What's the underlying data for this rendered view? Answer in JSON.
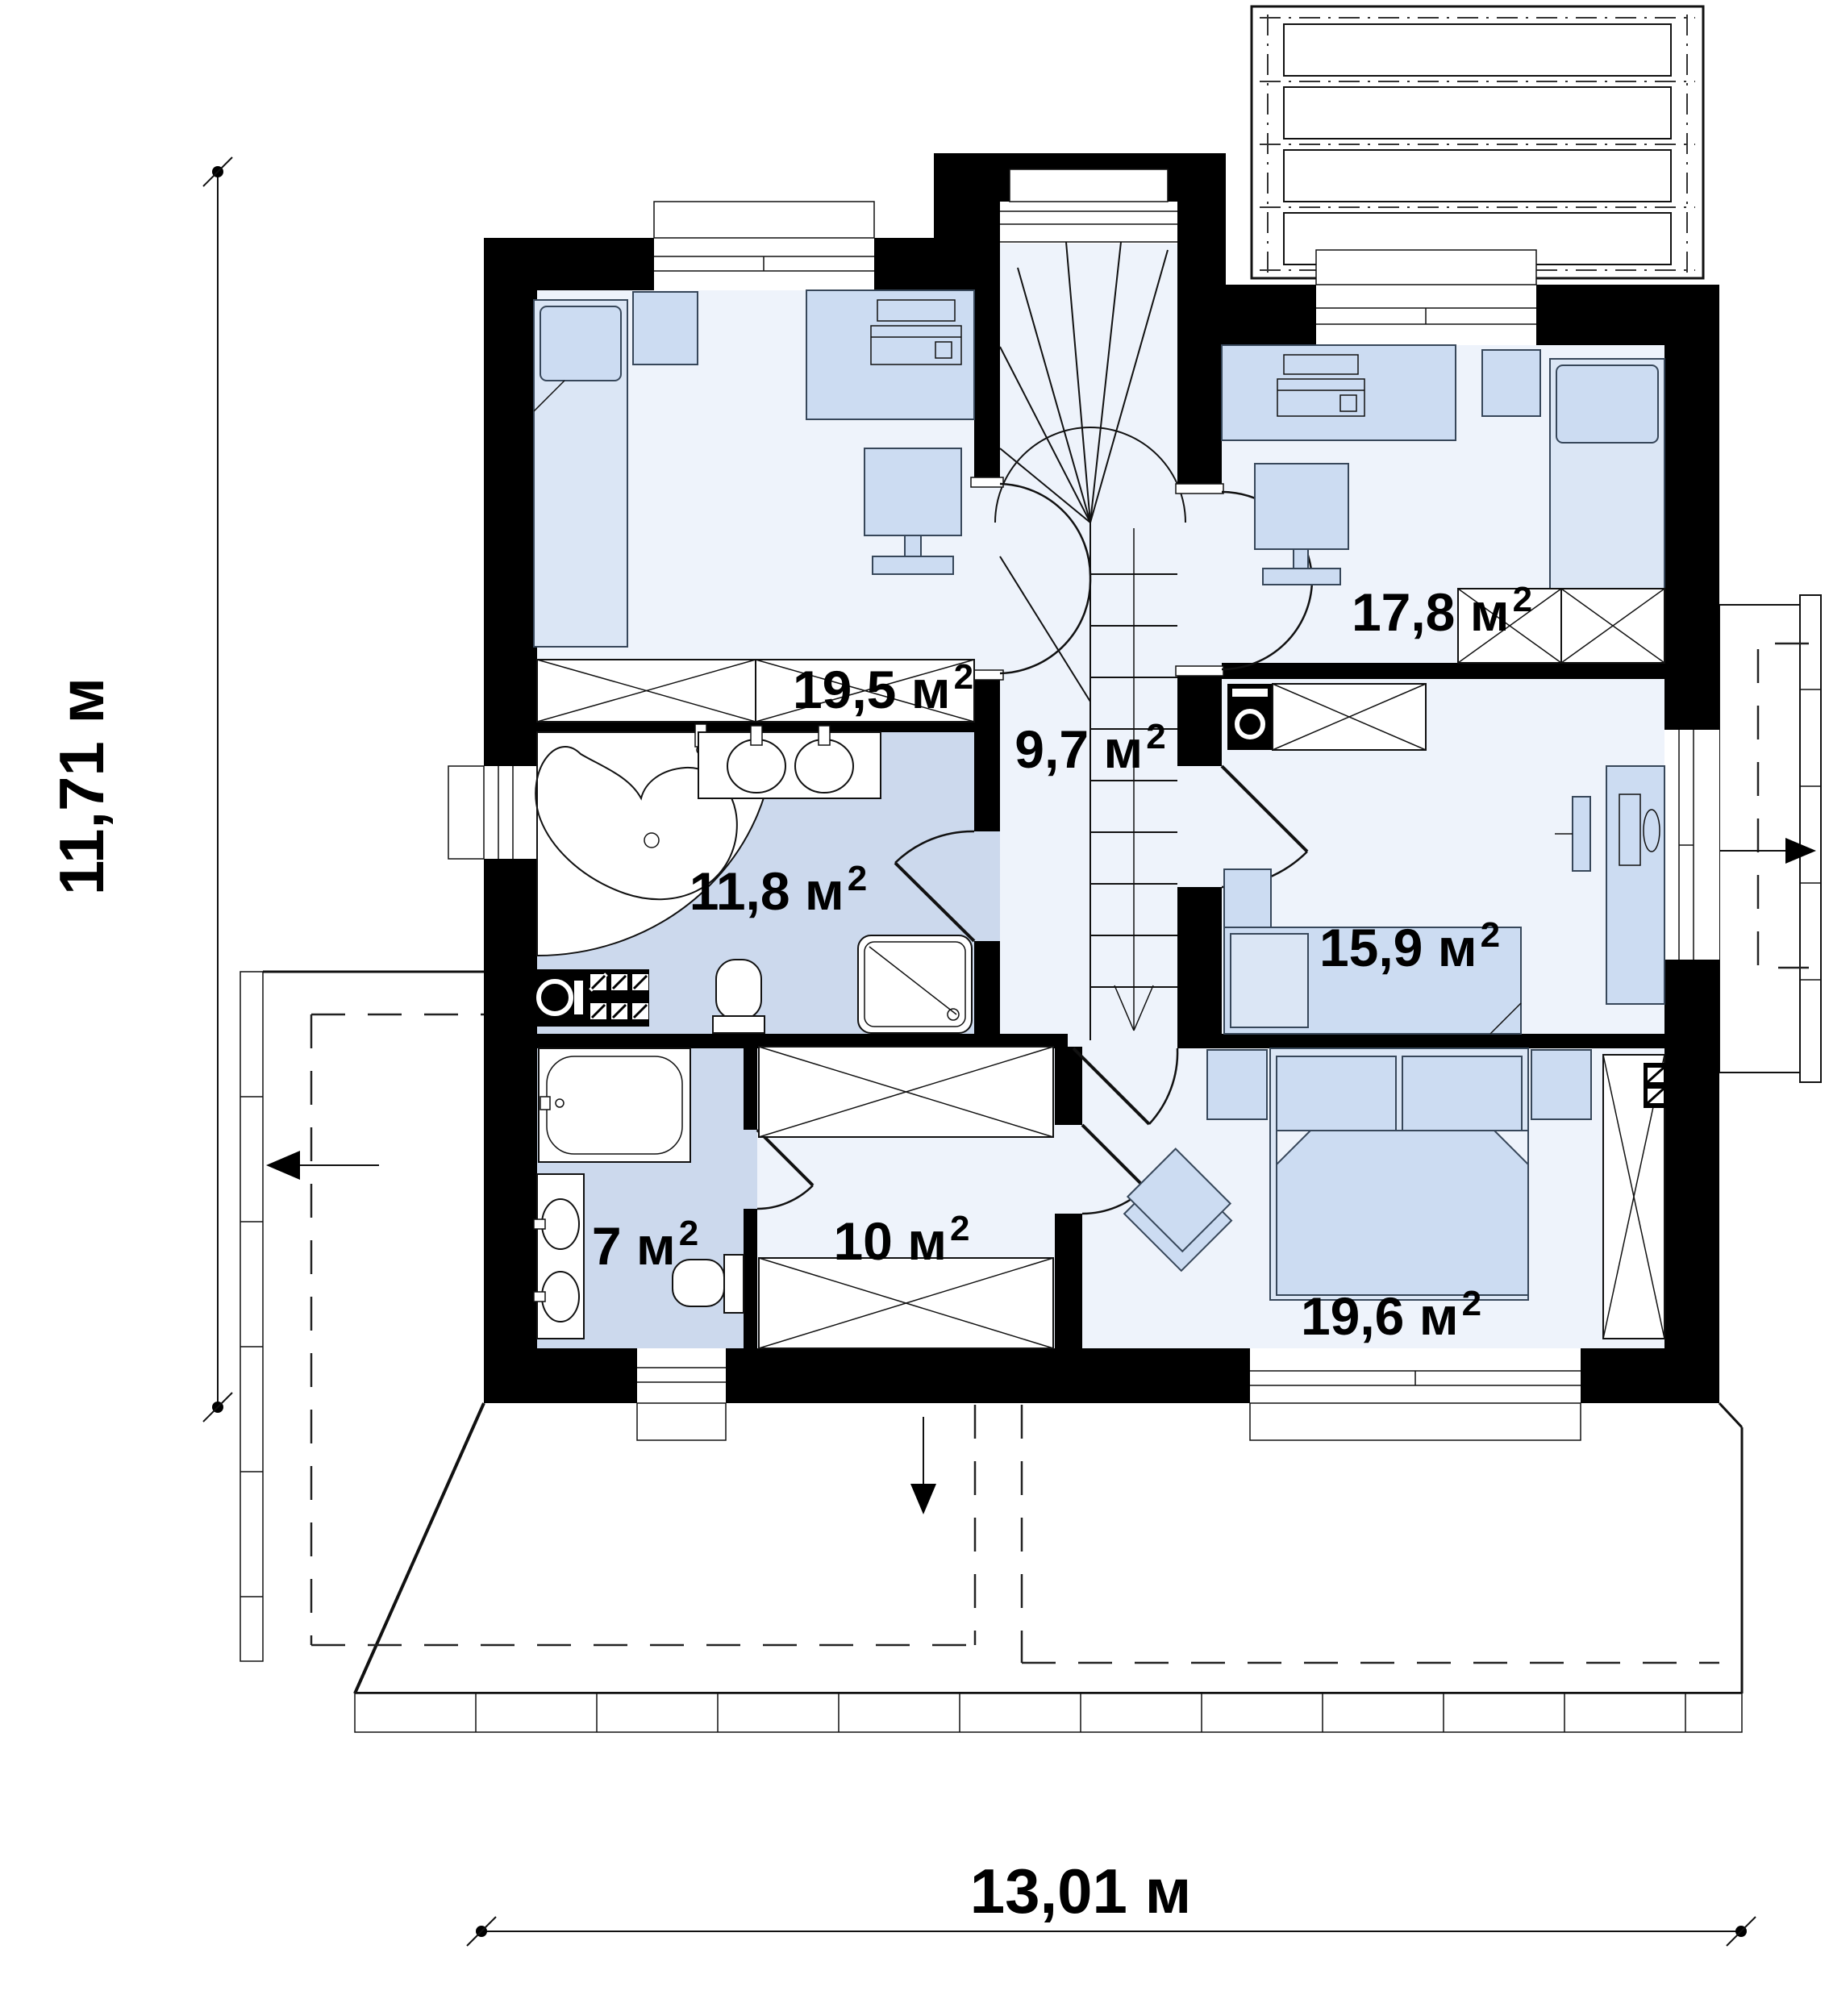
{
  "rooms": [
    {
      "id": "bedroom-top-left",
      "label": "19,5 м",
      "sup": "2"
    },
    {
      "id": "hall-staircase",
      "label": "9,7 м",
      "sup": "2"
    },
    {
      "id": "bedroom-top-right",
      "label": "17,8 м",
      "sup": "2"
    },
    {
      "id": "bathroom-main",
      "label": "11,8 м",
      "sup": "2"
    },
    {
      "id": "bedroom-right",
      "label": "15,9 м",
      "sup": "2"
    },
    {
      "id": "bathroom-small",
      "label": "7 м",
      "sup": "2"
    },
    {
      "id": "wardrobe-room",
      "label": "10 м",
      "sup": "2"
    },
    {
      "id": "bedroom-master",
      "label": "19,6 м",
      "sup": "2"
    }
  ],
  "dimensions": {
    "vertical": "11,71 м",
    "horizontal": "13,01 м"
  },
  "colors": {
    "wall": "#000000",
    "room_floor": "#eef3fb",
    "bathroom_floor": "#ccd9ed",
    "furniture": "#ccdcf2",
    "furniture_light": "#dbe6f5",
    "outline": "#111111"
  }
}
